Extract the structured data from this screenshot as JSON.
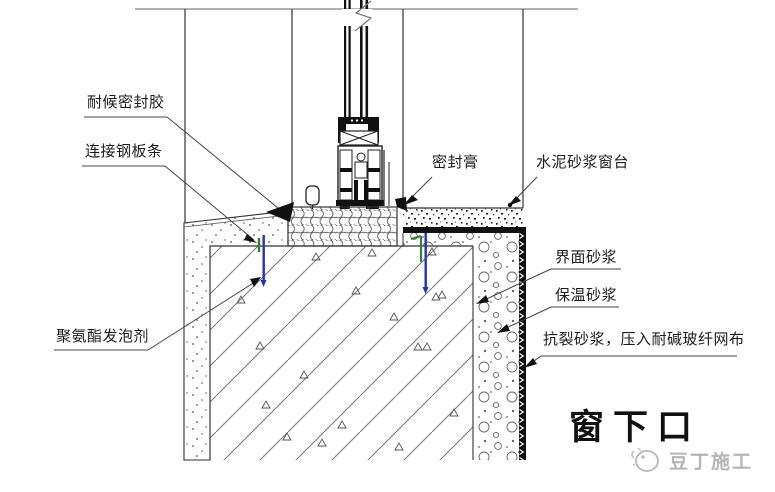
{
  "labels": {
    "weather_sealant": "耐候密封胶",
    "steel_strip": "连接钢板条",
    "pu_foam": "聚氨酯发泡剂",
    "sealing_paste": "密封膏",
    "cement_sill": "水泥砂浆窗台",
    "interface_mortar": "界面砂浆",
    "insulation_mortar": "保温砂浆",
    "anticrack_mortar": "抗裂砂浆，压入耐碱玻纤网布"
  },
  "title": "窗下口",
  "watermark": {
    "text": "豆丁施工"
  },
  "colors": {
    "line": "#333333",
    "hatch": "#666666",
    "anchor_blue": "#2233bb",
    "anchor_green": "#3a7d35",
    "watermark_gray": "#b5b5b5"
  }
}
